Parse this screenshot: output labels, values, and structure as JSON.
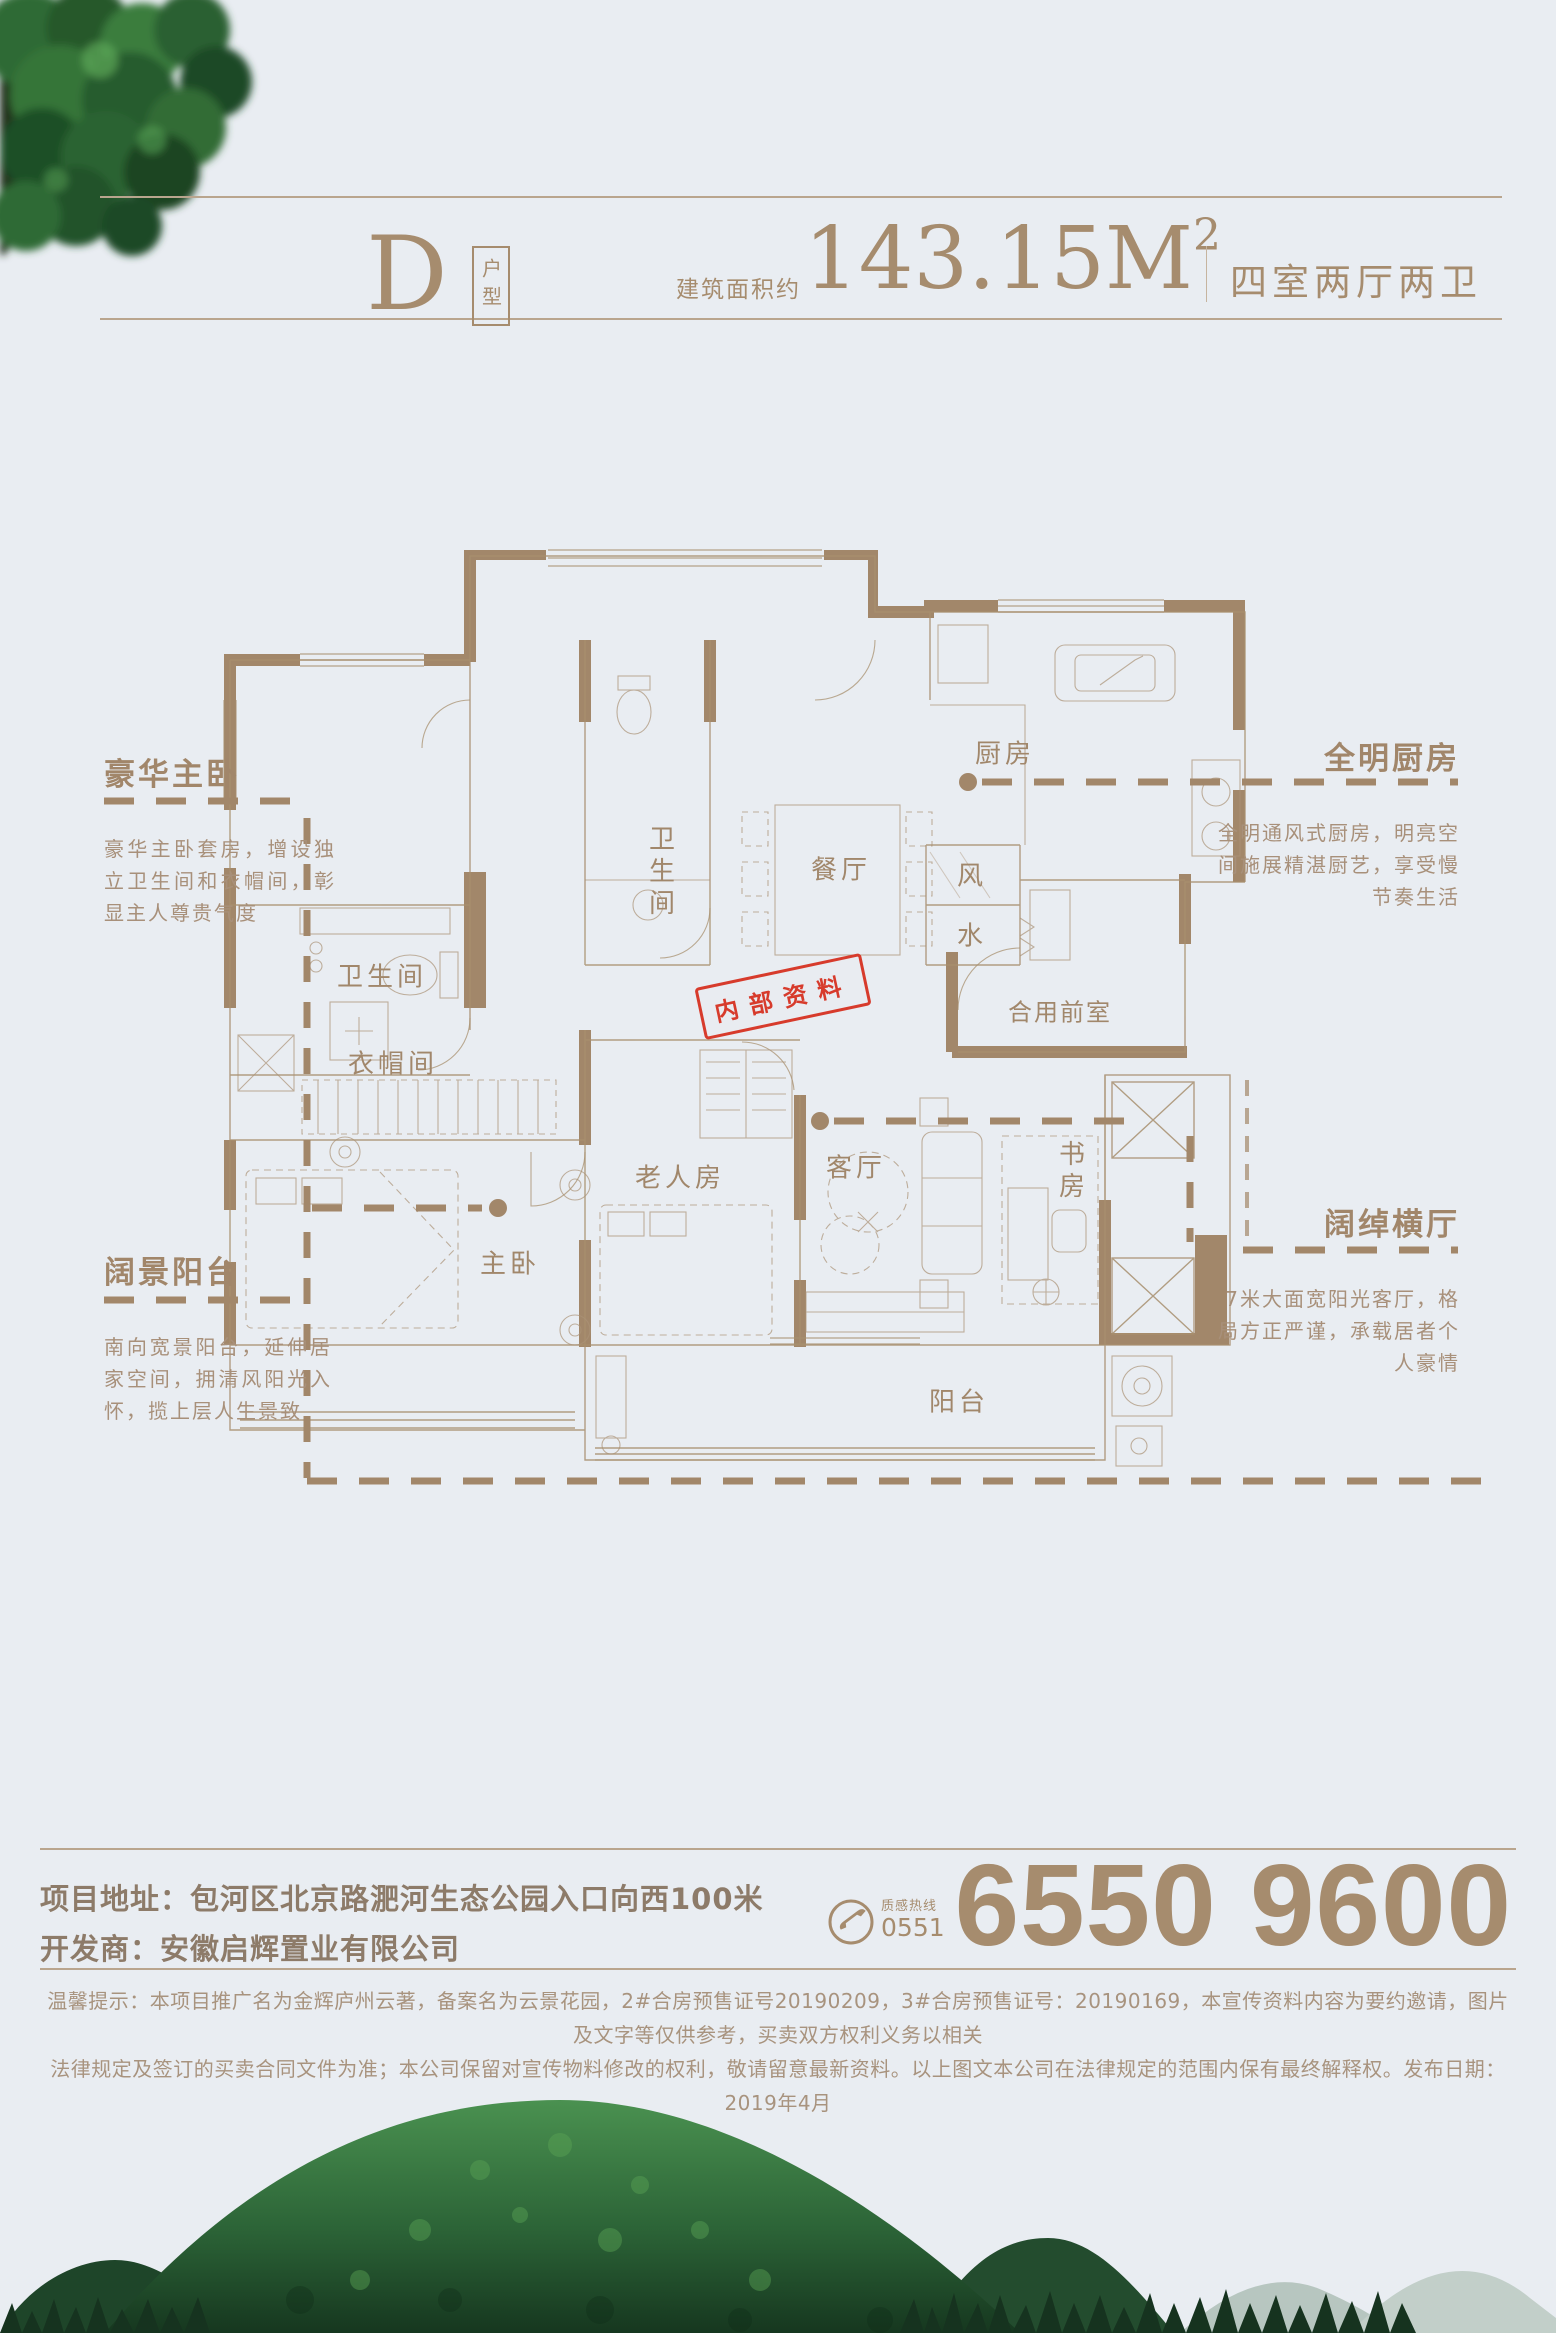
{
  "header": {
    "plan_letter": "D",
    "plan_type": "户型",
    "area_label": "建筑面积约",
    "area_value": "143.15M",
    "area_sup": "2",
    "rooms_spec": "四室两厅两卫"
  },
  "callouts": {
    "master_suite": {
      "title": "豪华主卧",
      "body": "豪华主卧套房，增设独立卫生间和衣帽间，彰显主人尊贵气度"
    },
    "view_balcony": {
      "title": "阔景阳台",
      "body": "南向宽景阳台，延伸居家空间，拥清风阳光入怀，揽上层人生景致"
    },
    "bright_kitchen": {
      "title": "全明厨房",
      "body": "全明通风式厨房，明亮空间施展精湛厨艺，享受慢节奏生活"
    },
    "wide_hall": {
      "title": "阔绰横厅",
      "body": "7米大面宽阳光客厅，格局方正严谨，承载居者个人豪情"
    }
  },
  "floorplan": {
    "stamp": "内部资料",
    "rooms": {
      "kitchen": "厨房",
      "dining": "餐厅",
      "bath_center": "卫生间",
      "bath_left": "卫生间",
      "cloak": "衣帽间",
      "master": "主卧",
      "elder": "老人房",
      "living": "客厅",
      "study": "书房",
      "balcony": "阳台",
      "foyer": "合用前室",
      "wind": "风",
      "water": "水"
    }
  },
  "footer": {
    "address_line": "项目地址：包河区北京路淝河生态公园入口向西100米",
    "developer_line": "开发商：安徽启辉置业有限公司",
    "hotline_name": "质感热线",
    "hotline_area": "0551",
    "phone": "6550 9600",
    "disclaimer_line1": "温馨提示：本项目推广名为金辉庐州云著，备案名为云景花园，2#合房预售证号20190209，3#合房预售证号：20190169，本宣传资料内容为要约邀请，图片及文字等仅供参考，买卖双方权利义务以相关",
    "disclaimer_line2": "法律规定及签订的买卖合同文件为准；本公司保留对宣传物料修改的权利，敬请留意最新资料。以上图文本公司在法律规定的范围内保有最终解释权。发布日期：2019年4月"
  },
  "colors": {
    "tan": "#a68c6e",
    "wall": "#a2876a",
    "red": "#d73b2c",
    "background": "#e9edf2"
  }
}
